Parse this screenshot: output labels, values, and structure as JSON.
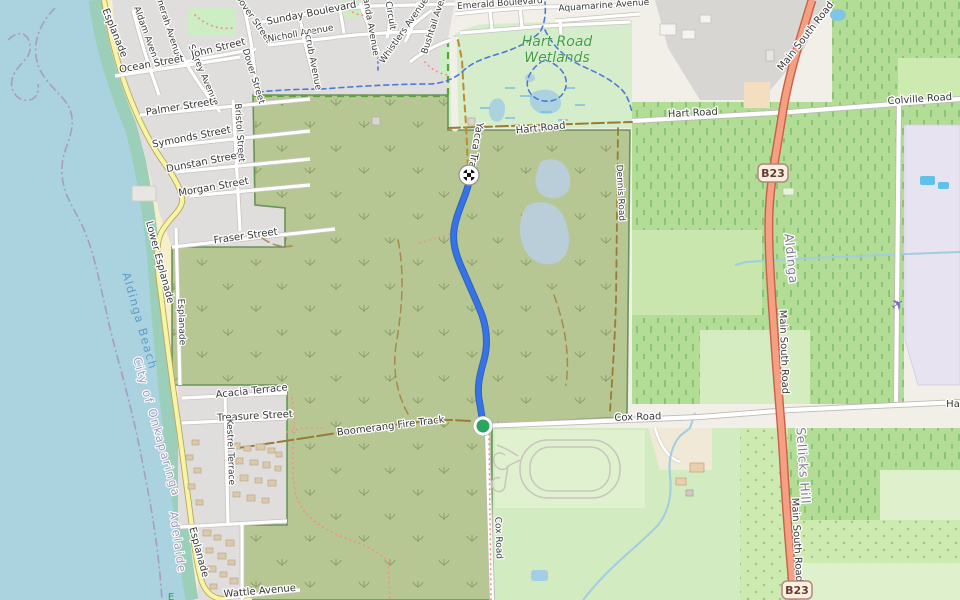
{
  "labels": {
    "esplanade_top": "Esplanade",
    "aldam": "Aldam Avenue",
    "nnerah": "nnerah Avenue",
    "storey": "Storey Avenue",
    "dover_a": "Dover Street",
    "dover_b": "Dover Street",
    "ocean": "Ocean Street",
    "john": "John Street",
    "sunday": "Sunday Boulevard",
    "nicholl": "Nicholl Avenue",
    "scrub_av": "Scrub Avenue",
    "aruanda": "aruanda Avenue",
    "circuit": "Circuit",
    "whistlers": "Whistlers Avenue",
    "bushtail": "Bushtail Avenue",
    "emerald": "Emerald Boulevard",
    "aquamarine": "Aquamarine Avenue",
    "palmer": "Palmer Street",
    "symonds": "Symonds Street",
    "dunstan": "Dunstan Street",
    "morgan": "Morgan Street",
    "fraser": "Fraser Street",
    "bristol": "Bristol Street",
    "lower_esplanade": "Lower Esplanade",
    "esplanade_mid": "Esplanade",
    "esplanade_bottom": "Esplanade",
    "acacia": "Acacia Terrace",
    "treasure": "Treasure Street",
    "kestrel": "Kestrel Terrace",
    "wattle": "Wattle Avenue",
    "hart_track": "Hart Road",
    "hart": "Hart Road",
    "colville": "Colville Road",
    "cox": "Cox Road",
    "cox_south": "Cox Road",
    "ha_partial": "Ha",
    "boomerang": "Boomerang Fire Track",
    "yacca": "Yacca Track",
    "dennis": "Dennis Road",
    "main_south_a": "Main South Road",
    "main_south_b": "Main South Road",
    "main_south_c": "Main South Road",
    "b23": "B23",
    "e_partial": "E"
  },
  "places": {
    "aldinga": "Aldinga",
    "sellicks": "Sellicks Hill",
    "adelaide": "Adelaide",
    "onkaparinga": "City of Onkaparinga",
    "aldinga_beach": "Aldinga Beach",
    "wetlands_line1": "Hart Road",
    "wetlands_line2": "Wetlands"
  },
  "route": {
    "color": "#3573e8",
    "casing": "#2456b8",
    "start_color": "#2aa45e"
  },
  "colors": {
    "water": "#aad3df",
    "tidal": "#9bcfba",
    "sand": "#f6efca",
    "scrub": "#b6c793",
    "wetland": "#d5edca",
    "orchard": "#b3dd97",
    "field": "#cdebb0",
    "residential": "#e0dedd",
    "trunk": "#f5a083",
    "badge_fill": "#fdf0dc",
    "badge_border": "#b48484"
  },
  "icons": {
    "finish": "checkered-flag-icon",
    "start": "start-dot-icon",
    "plane": "airplane-icon"
  }
}
